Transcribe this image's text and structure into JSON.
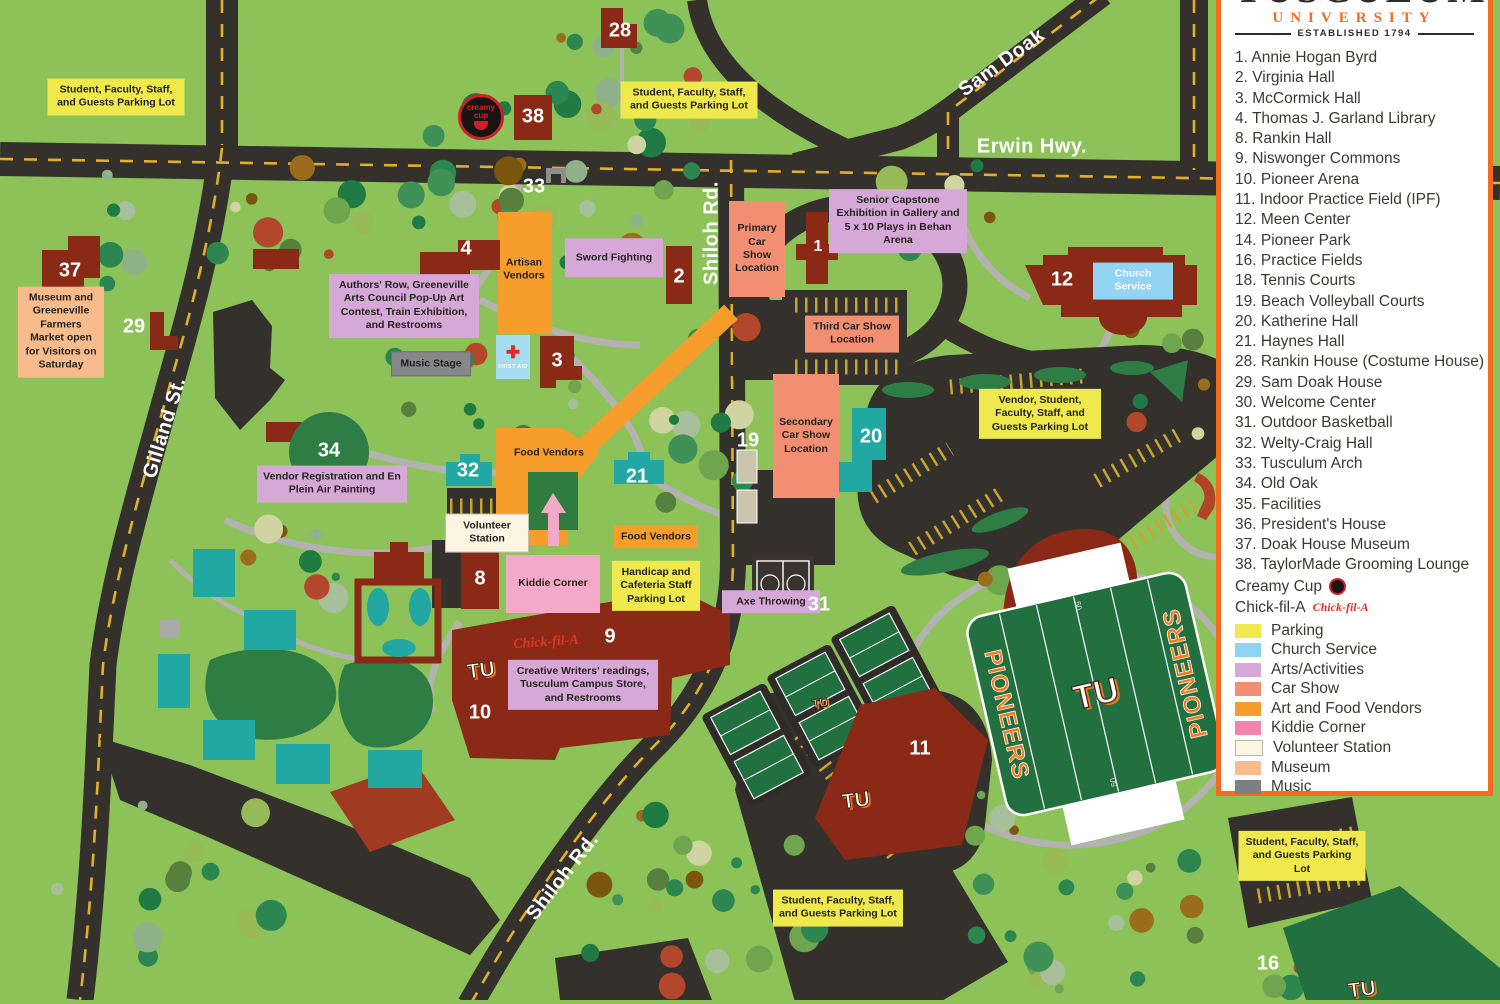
{
  "legend": {
    "logo_title": "TUSCULUM",
    "logo_subtitle": "UNIVERSITY",
    "logo_established": "ESTABLISHED 1794",
    "items": [
      {
        "num": "1",
        "name": "Annie Hogan Byrd"
      },
      {
        "num": "2",
        "name": "Virginia Hall"
      },
      {
        "num": "3",
        "name": "McCormick Hall"
      },
      {
        "num": "4",
        "name": "Thomas J. Garland Library"
      },
      {
        "num": "8",
        "name": "Rankin Hall"
      },
      {
        "num": "9",
        "name": "Niswonger Commons"
      },
      {
        "num": "10",
        "name": "Pioneer Arena"
      },
      {
        "num": "11",
        "name": "Indoor Practice Field (IPF)"
      },
      {
        "num": "12",
        "name": "Meen Center"
      },
      {
        "num": "14",
        "name": "Pioneer Park"
      },
      {
        "num": "16",
        "name": "Practice Fields"
      },
      {
        "num": "18",
        "name": "Tennis Courts"
      },
      {
        "num": "19",
        "name": "Beach Volleyball Courts"
      },
      {
        "num": "20",
        "name": "Katherine Hall"
      },
      {
        "num": "21",
        "name": "Haynes Hall"
      },
      {
        "num": "28",
        "name": "Rankin House (Costume House)"
      },
      {
        "num": "29",
        "name": "Sam Doak House"
      },
      {
        "num": "30",
        "name": "Welcome Center"
      },
      {
        "num": "31",
        "name": "Outdoor Basketball"
      },
      {
        "num": "32",
        "name": "Welty-Craig Hall"
      },
      {
        "num": "33",
        "name": "Tusculum Arch"
      },
      {
        "num": "34",
        "name": "Old Oak"
      },
      {
        "num": "35",
        "name": "Facilities"
      },
      {
        "num": "36",
        "name": "President's House"
      },
      {
        "num": "37",
        "name": "Doak House Museum"
      },
      {
        "num": "38",
        "name": "TaylorMade Grooming Lounge"
      }
    ],
    "vendors": [
      {
        "name": "Creamy Cup",
        "icon": "creamy-cup-logo"
      },
      {
        "name": "Chick-fil-A",
        "icon": "chick-fil-a-logo"
      }
    ],
    "categories": [
      {
        "label": "Parking",
        "color": "#f0e94e"
      },
      {
        "label": "Church Service",
        "color": "#8ed3f3"
      },
      {
        "label": "Arts/Activities",
        "color": "#d6a8d7"
      },
      {
        "label": "Car Show",
        "color": "#f28e71"
      },
      {
        "label": "Art and Food Vendors",
        "color": "#f69d2c"
      },
      {
        "label": "Kiddie Corner",
        "color": "#f584ad"
      },
      {
        "label": "Volunteer Station",
        "color": "#fbf5e1",
        "border": "#b9b5a8"
      },
      {
        "label": "Museum",
        "color": "#f8bb8b"
      },
      {
        "label": "Music",
        "color": "#7f7e83"
      }
    ]
  },
  "map": {
    "roads": {
      "erwin": "Erwin Hwy.",
      "sam_doak": "Sam Doak",
      "shiloh": "Shiloh Rd.",
      "gilland": "Gilland St."
    },
    "labels": {
      "parking_generic": "Student, Faculty, Staff, and Guests Parking Lot",
      "parking_vendor": "Vendor, Student, Faculty, Staff, and Guests Parking Lot",
      "parking_handicap": "Handicap and Cafeteria Staff Parking Lot",
      "museum": "Museum and Greeneville Farmers Market open for Visitors on Saturday",
      "authors_row": "Authors' Row, Greeneville Arts Council Pop-Up Art Contest, Train Exhibition, and Restrooms",
      "senior_capstone": "Senior Capstone Exhibition in Gallery and 5 x 10 Plays in Behan Arena",
      "sword_fighting": "Sword Fighting",
      "artisan_vendors": "Artisan Vendors",
      "food_vendors": "Food Vendors",
      "music_stage": "Music Stage",
      "vendor_registration": "Vendor Registration and En Plein Air Painting",
      "volunteer_station": "Volunteer Station",
      "kiddie_corner": "Kiddie Corner",
      "creative_writers": "Creative Writers' readings, Tusculum Campus Store, and Restrooms",
      "axe_throwing": "Axe Throwing",
      "primary_car_show": "Primary Car Show Location",
      "secondary_car_show": "Secondary Car Show Location",
      "third_car_show": "Third Car Show Location",
      "church_service": "Church Service",
      "first_aid": "FIRST AID"
    },
    "numbers": {
      "1": "1",
      "2": "2",
      "3": "3",
      "4": "4",
      "8": "8",
      "9": "9",
      "10": "10",
      "11": "11",
      "12": "12",
      "16": "16",
      "19": "19",
      "20": "20",
      "21": "21",
      "28": "28",
      "29": "29",
      "31": "31",
      "32": "32",
      "33": "33",
      "34": "34",
      "37": "37",
      "38": "38",
      "50": "50"
    },
    "logos": {
      "tu": "TU",
      "pioneers": "PIONEERS",
      "creamy_top": "creamy",
      "creamy_bottom": "cup",
      "chick_fil_a": "Chick-fil-A"
    }
  }
}
